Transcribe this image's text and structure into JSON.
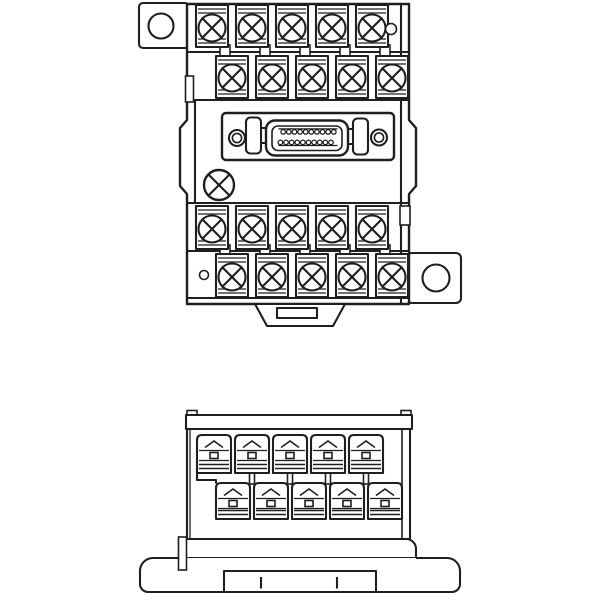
{
  "title": "terminal-block-interface-module-line-drawing",
  "background": "#ffffff",
  "line_color": "#1f1f1f",
  "views": {
    "top_view": {
      "name": "top-view",
      "screw_terminal_rows": 4,
      "terminals_per_row": 5,
      "total_screw_terminals": 20,
      "mounting_tabs": 2,
      "mounting_holes": 2,
      "connector": {
        "type": "half-pitch-socket",
        "pins_top_row": 10,
        "pins_bottom_row": 10,
        "total_pins": 20,
        "lock_latches": 2,
        "panel_holes": 2
      },
      "captive_screws": 1,
      "small_holes": 2,
      "din_rail_latch": 1
    },
    "front_view": {
      "name": "front-view",
      "screw_terminal_rows": 2,
      "terminals_per_row": 5,
      "total_screw_terminals": 10,
      "din_rail_base": 1,
      "base_tick_marks": 2
    }
  },
  "geometry": {
    "top_view": {
      "screw_r": 13.5,
      "rows": [
        {
          "xs": [
            196,
            236,
            276,
            316,
            356
          ],
          "y": 5,
          "w": 32,
          "h": 42,
          "screw_cy": 28
        },
        {
          "xs": [
            216,
            256,
            296,
            336,
            376
          ],
          "y": 56,
          "w": 32,
          "h": 42,
          "screw_cy": 78,
          "neck_y": 45
        },
        {
          "xs": [
            196,
            236,
            276,
            316,
            356
          ],
          "y": 206,
          "w": 32,
          "h": 43,
          "screw_cy": 229
        },
        {
          "xs": [
            216,
            256,
            296,
            336,
            376
          ],
          "y": 254,
          "w": 32,
          "h": 43,
          "screw_cy": 277,
          "neck_y": 245
        }
      ],
      "pins": {
        "top": {
          "count": 10,
          "x0": 283.2,
          "pitch": 5.62,
          "cy": 131.9,
          "r": 2.3
        },
        "bottom": {
          "count": 10,
          "x0": 280.4,
          "pitch": 5.62,
          "cy": 142.4,
          "r": 2.3
        }
      }
    },
    "front_view": {
      "rows": [
        {
          "xs": [
            197,
            235,
            273,
            311,
            349
          ],
          "y": 435,
          "w": 34,
          "h": 38
        },
        {
          "xs": [
            216,
            254,
            292,
            330,
            368
          ],
          "y": 483,
          "w": 34,
          "h": 36
        }
      ],
      "post_y": 471,
      "post_h": 13
    }
  }
}
